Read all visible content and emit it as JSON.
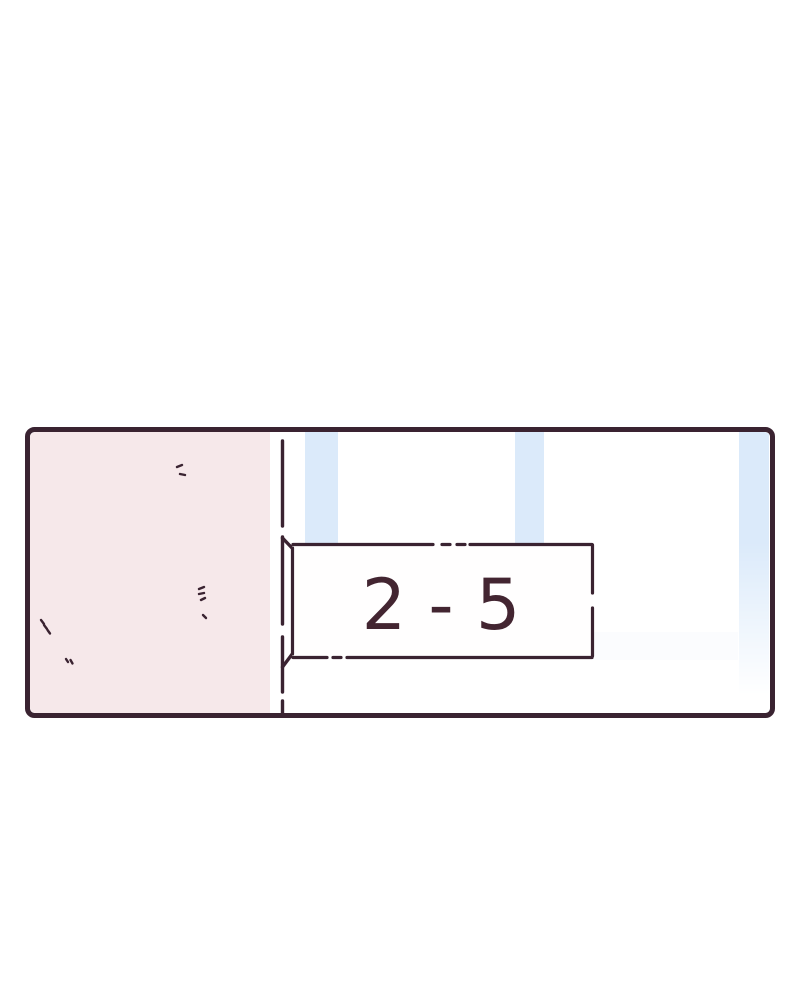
{
  "panel": {
    "sign": {
      "label": "2 - 5"
    },
    "colors": {
      "outline": "#3a2331",
      "wall_pink": "#f6e8ea",
      "wall_white": "#ffffff",
      "stripe_blue": "#dbeafa",
      "sign_fill": "#fffefe",
      "sign_text": "#432531",
      "page_background": "#ffffff"
    }
  }
}
